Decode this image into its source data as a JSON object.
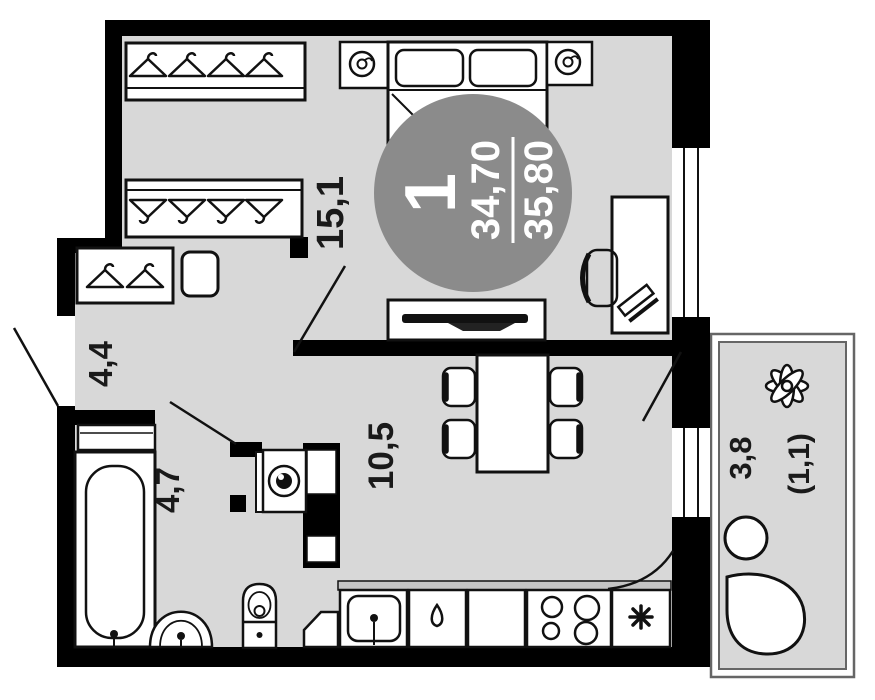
{
  "plan": {
    "title": "1-room apartment floor plan",
    "badge": {
      "unit_number": "1",
      "area_living": "34,70",
      "area_total": "35,80"
    },
    "rooms": {
      "bedroom": {
        "name": "bedroom-with-closet",
        "area": "15,1"
      },
      "hallway": {
        "name": "hallway",
        "area": "4,4"
      },
      "bathroom": {
        "name": "bathroom",
        "area": "4,7"
      },
      "kitchen_living": {
        "name": "kitchen-living",
        "area": "10,5"
      },
      "balcony": {
        "name": "balcony",
        "area": "3,8",
        "area_reduced": "(1,1)"
      }
    },
    "colors": {
      "wall": "#000000",
      "floor": "#d8d8d8",
      "counter_strip": "#c4c4c4",
      "badge": "#8b8b8b",
      "line": "#111111",
      "balcony_outline": "#666666"
    }
  }
}
